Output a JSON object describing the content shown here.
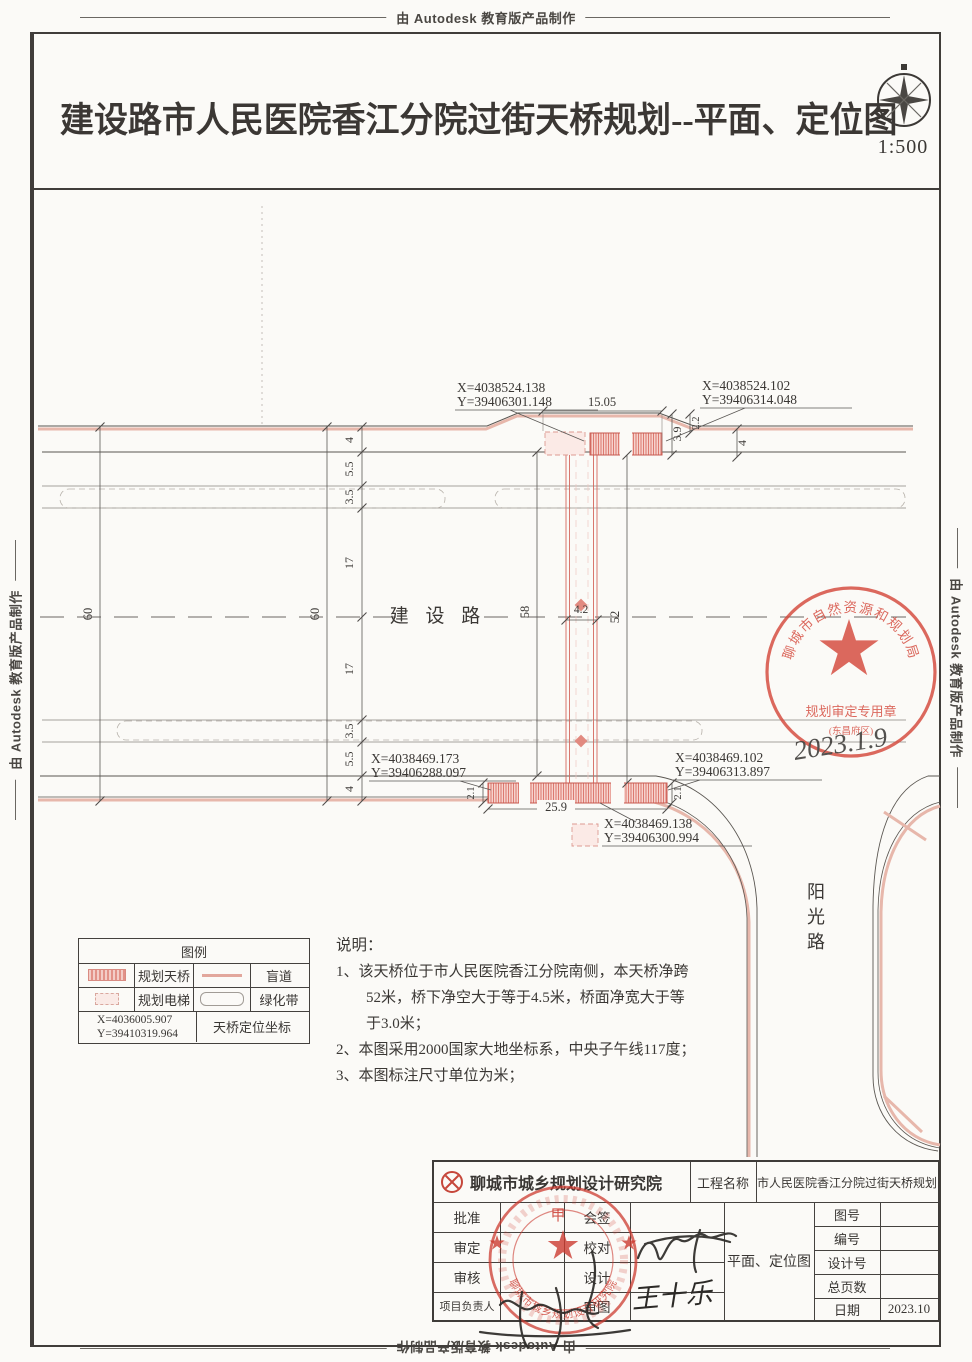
{
  "banner": {
    "text": "由 Autodesk 教育版产品制作"
  },
  "header": {
    "title": "建设路市人民医院香江分院过街天桥规划--平面、定位图",
    "scale": "1:500"
  },
  "plan": {
    "roads": {
      "east_west": "建 设 路",
      "north_south": [
        "阳",
        "光",
        "路"
      ]
    },
    "coordinates": {
      "north_west": {
        "x": "X=4038524.138",
        "y": "Y=39406301.148"
      },
      "north_east": {
        "x": "X=4038524.102",
        "y": "Y=39406314.048"
      },
      "south_west": {
        "x": "X=4038469.173",
        "y": "Y=39406288.097"
      },
      "south_east": {
        "x": "X=4038469.102",
        "y": "Y=39406313.897"
      },
      "south_mid": {
        "x": "X=4038469.138",
        "y": "Y=39406300.994"
      }
    },
    "dimensions": {
      "road_total_west": "60",
      "road_total_mid": "60",
      "lane_chain": [
        "4",
        "5.5",
        "3.5",
        "17",
        "17",
        "3.5",
        "5.5",
        "4"
      ],
      "landing_north_length": "15.05",
      "landing_north_depth": "3.9",
      "landing_north_offset": "2.2",
      "sidewalk_north": "4",
      "landing_south_length": "25.9",
      "landing_south_depth_west": "2.1",
      "landing_south_depth_east": "2.1",
      "span_west": "58",
      "bridge_width": "4.2",
      "span_east": "52"
    },
    "approval_stamp": {
      "agency": "聊城市自然资源和规划局",
      "purpose": "规划审定专用章",
      "district": "(东昌府区)",
      "handwritten_date": "2023.1.9"
    }
  },
  "legend": {
    "title": "图例",
    "items": [
      {
        "label": "规划天桥",
        "symbol": "red-hatched-bar"
      },
      {
        "label": "盲道",
        "symbol": "pink-line"
      },
      {
        "label": "规划电梯",
        "symbol": "dashed-box"
      },
      {
        "label": "绿化带",
        "symbol": "rounded-outline"
      }
    ],
    "datum": {
      "x": "X=4036005.907",
      "y": "Y=39410319.964",
      "label": "天桥定位坐标"
    }
  },
  "notes": {
    "heading": "说明：",
    "lines": [
      "1、该天桥位于市人民医院香江分院南侧，本天桥净跨",
      "52米，桥下净空大于等于4.5米，桥面净宽大于等",
      "于3.0米；",
      "2、本图采用2000国家大地坐标系，中央子午线117度；",
      "3、本图标注尺寸单位为米；"
    ]
  },
  "titleblock": {
    "institute": "聊城市城乡规划设计研究院",
    "project_label": "工程名称",
    "project_name": "市人民医院香江分院过街天桥规划",
    "drawing_name": "平面、定位图",
    "left_rows": [
      {
        "a": "批准",
        "b": "会签"
      },
      {
        "a": "审定",
        "b": "校对"
      },
      {
        "a": "审核",
        "b": "设计"
      },
      {
        "a": "项目负责人",
        "b": "审图"
      }
    ],
    "right_rows": [
      {
        "label": "图号",
        "value": ""
      },
      {
        "label": "编号",
        "value": ""
      },
      {
        "label": "设计号",
        "value": ""
      },
      {
        "label": "总页数",
        "value": ""
      },
      {
        "label": "日期",
        "value": "2023.10"
      }
    ],
    "signature": "王十乐",
    "cert_grade": "甲",
    "institute_seal_text": "聊城市城乡规划设计研究院"
  }
}
